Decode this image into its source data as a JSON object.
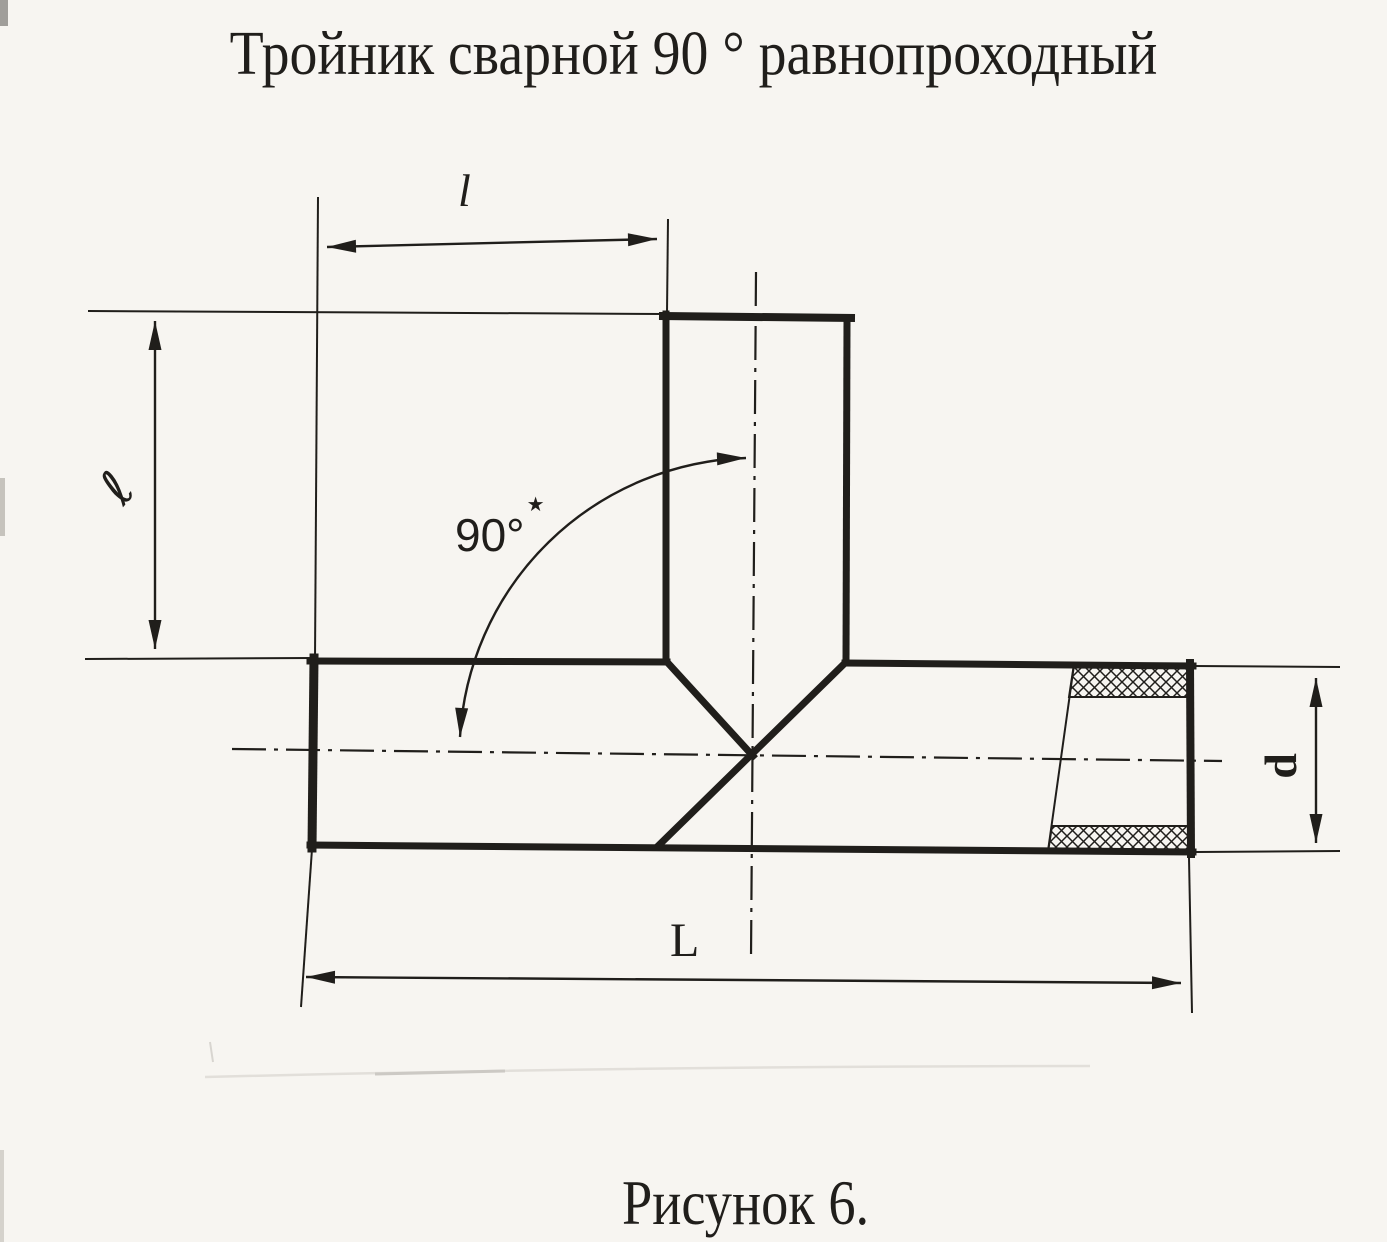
{
  "figure": {
    "title": "Тройник сварной 90 ° равнопроходный",
    "caption": "Рисунок 6."
  },
  "dimensions": {
    "branch_length_label": "l",
    "branch_height_label": "ℓ",
    "angle_value": "90°",
    "angle_footnote_mark": "★",
    "overall_length_label": "L",
    "diameter_label": "d"
  },
  "colors": {
    "ink": "#201e1b",
    "paper": "#f7f5f1"
  }
}
